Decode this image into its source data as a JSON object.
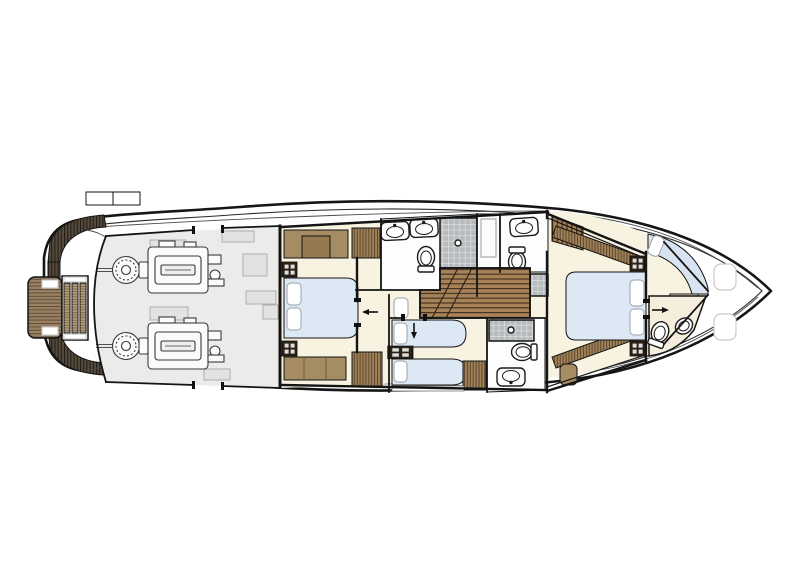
{
  "meta": {
    "description": "Yacht lower-deck general arrangement floor plan, top view, bow facing right",
    "deck": "lower deck"
  },
  "areas": [
    "swim platform",
    "stern steps",
    "engine room",
    "vip cabin",
    "vip bathroom",
    "day head",
    "central staircase",
    "twin guest cabin",
    "guest shower room",
    "master cabin",
    "master bathroom",
    "foredeck lockers"
  ],
  "fixtures": {
    "engines": 2,
    "double_berths": 2,
    "single_berths": 2,
    "sinks": 4,
    "toilets": 4,
    "bidets": 1,
    "showers": 3
  },
  "colors": {
    "background": "#ffffff",
    "hull_fill": "#ffffff",
    "engine_room_floor": "#ebebe9",
    "equipment": "#e2e2e0",
    "cabin_floor": "#f8f2e1",
    "bathroom_floor": "#fdfdfd",
    "bow_bath_floor": "#f5eedd",
    "bed": "#dce8f4",
    "pillow": "#ffffff",
    "seat": "#d7e3f1",
    "furniture": "#a68c62",
    "furniture_inner": "#95794f",
    "hatch_base": "#a08257",
    "hatch_line": "#5c4730",
    "nightstand": "#2b2115",
    "teak_platform": "#998061",
    "teak_platform_line": "#5f4f3a",
    "teak_steps": "#b59c77",
    "teak_steps_line": "#75614a",
    "stern_band": "#544a3c",
    "stern_band_line": "#221c15",
    "stair_wood": "#a8835a",
    "stair_line": "#44331f",
    "tile": "#b7bbbd",
    "tile_line": "#d9dcdd",
    "vanity": "#efe5d0"
  }
}
